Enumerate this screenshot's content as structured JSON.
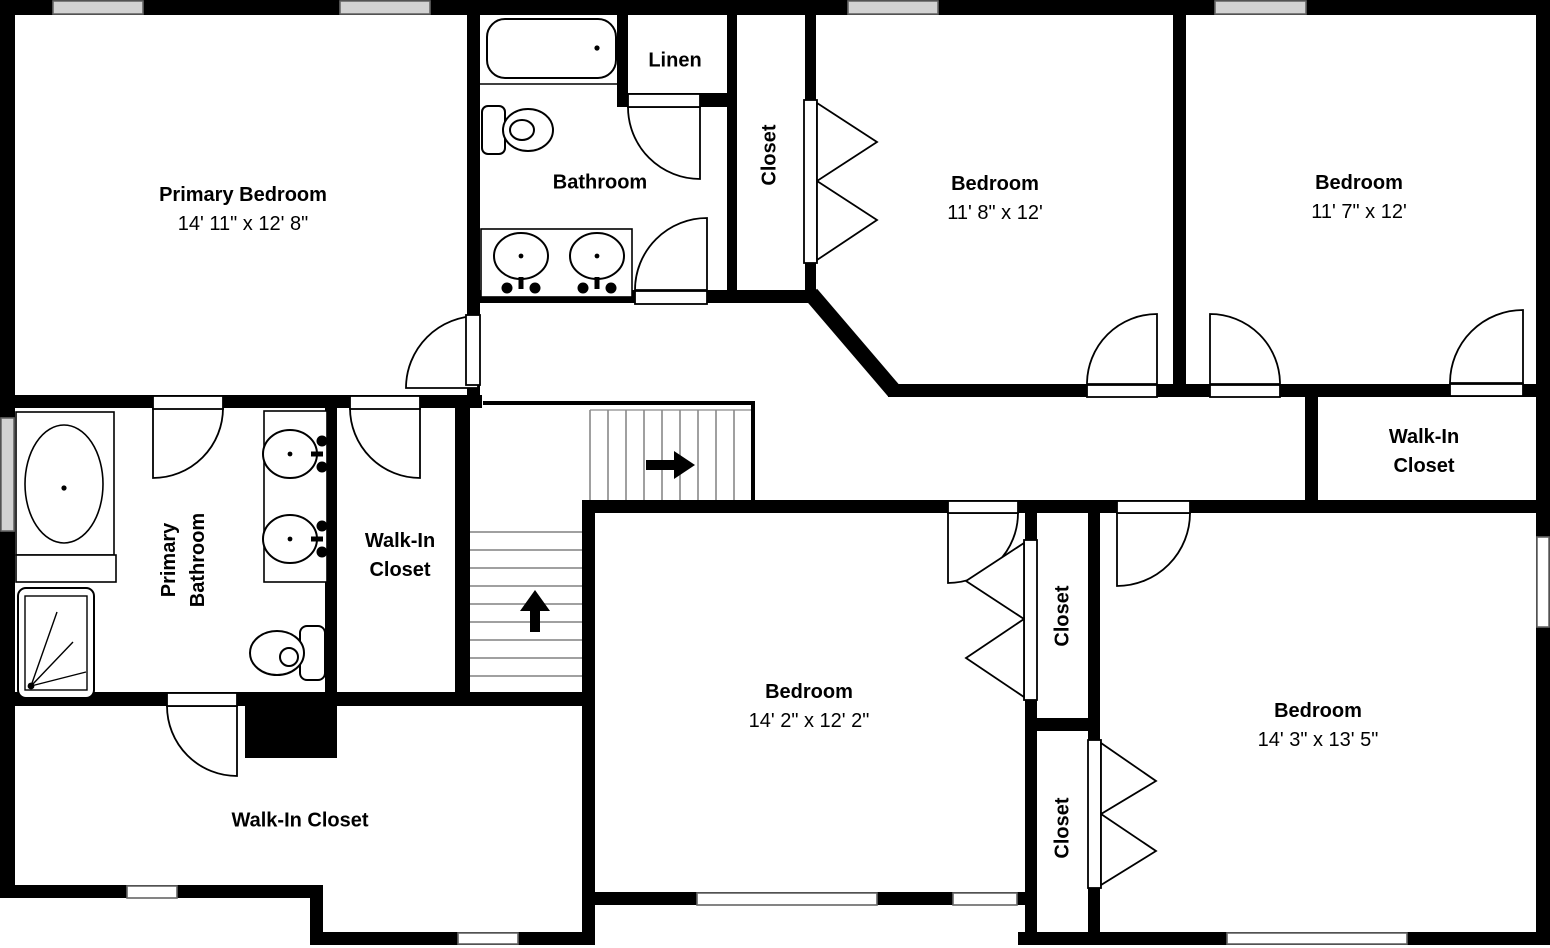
{
  "plan_type": "floor-plan",
  "colors": {
    "wall": "#000000",
    "background": "#ffffff",
    "window_fill_top": "#d2d2d2",
    "window_fill_bottom": "#ffffff",
    "window_border": "#666666",
    "stair_tread": "#808080",
    "text": "#000000"
  },
  "rooms": {
    "primary_bedroom": {
      "name": "Primary Bedroom",
      "dims": "14' 11\" x 12' 8\""
    },
    "bathroom": {
      "name": "Bathroom"
    },
    "linen": {
      "name": "Linen"
    },
    "closet_top": {
      "name": "Closet"
    },
    "bedroom_top_mid": {
      "name": "Bedroom",
      "dims": "11' 8\" x 12'"
    },
    "bedroom_top_right": {
      "name": "Bedroom",
      "dims": "11' 7\" x 12'"
    },
    "walk_in_closet_right": {
      "name": "Walk-In Closet"
    },
    "primary_bathroom": {
      "name": "Primary Bathroom"
    },
    "walk_in_closet_middle": {
      "name": "Walk-In Closet"
    },
    "bedroom_bottom_mid": {
      "name": "Bedroom",
      "dims": "14' 2\" x 12' 2\""
    },
    "closet_middle": {
      "name": "Closet"
    },
    "closet_bottom": {
      "name": "Closet"
    },
    "bedroom_bottom_right": {
      "name": "Bedroom",
      "dims": "14' 3\" x 13' 5\""
    },
    "walk_in_closet_bottom": {
      "name": "Walk-In Closet"
    }
  },
  "fixtures": {
    "bathroom_tub": "bathtub",
    "bathroom_toilet": "toilet",
    "bathroom_vanity": "double-sink-vanity",
    "primary_tub": "garden-tub",
    "primary_shower": "shower",
    "primary_vanity": "double-sink-vanity",
    "primary_toilet": "toilet"
  },
  "stairs": {
    "upper_run_direction": "right",
    "lower_run_direction": "up",
    "up_arrow_icon": "arrow-up",
    "right_arrow_icon": "arrow-right"
  }
}
